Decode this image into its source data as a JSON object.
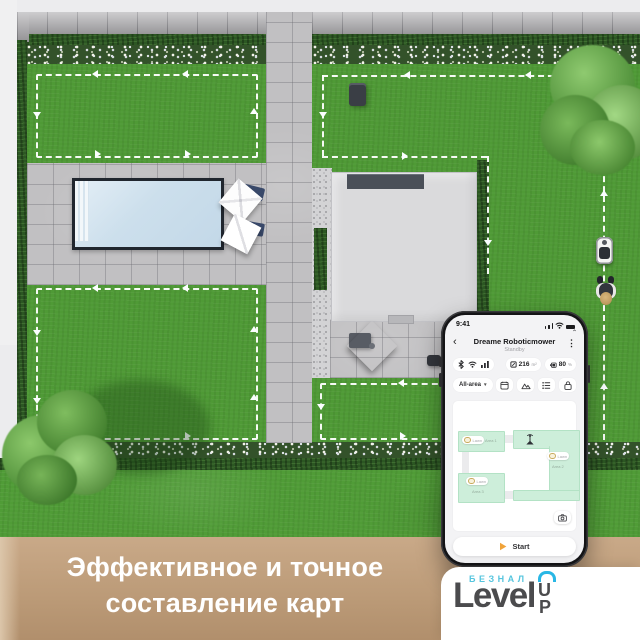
{
  "banner": {
    "line1": "Эффективное и точное",
    "line2": "составление карт"
  },
  "logo": {
    "sub": "БЕЗНАЛ",
    "main": "Level",
    "up_u": "U",
    "up_p": "P",
    "accent": "#29b7e5"
  },
  "phone": {
    "time": "9:41",
    "glyphs": {
      "collapse": "⌃",
      "back": "‹",
      "menu": "⋮",
      "caret": "▾"
    },
    "title": "Dreame Roboticmower",
    "subtitle": "Standby",
    "area": {
      "value": "216",
      "unit": "m²"
    },
    "battery": {
      "value": "80",
      "unit": "%"
    },
    "selector_label": "All-area",
    "icons": {
      "connectivity": [
        "bluetooth",
        "wifi",
        "signal"
      ],
      "metrics": [
        "area",
        "battery"
      ],
      "toolbar": [
        "schedule",
        "mow-zones",
        "task-list",
        "lock"
      ],
      "map": [
        "base-station",
        "remap-camera"
      ],
      "start": "play"
    },
    "map": {
      "zones": [
        {
          "badge": "Lawn",
          "label": "Area 1"
        },
        {
          "badge": "Lawn",
          "label": "Area 2"
        },
        {
          "badge": "Lawn",
          "label": "Area 3"
        }
      ]
    },
    "start_label": "Start"
  },
  "colors": {
    "zone_green": "#cdeeda",
    "play_orange": "#f0a33a",
    "banner_tan": "#bb9a77",
    "logo_blue": "#56c5de"
  }
}
